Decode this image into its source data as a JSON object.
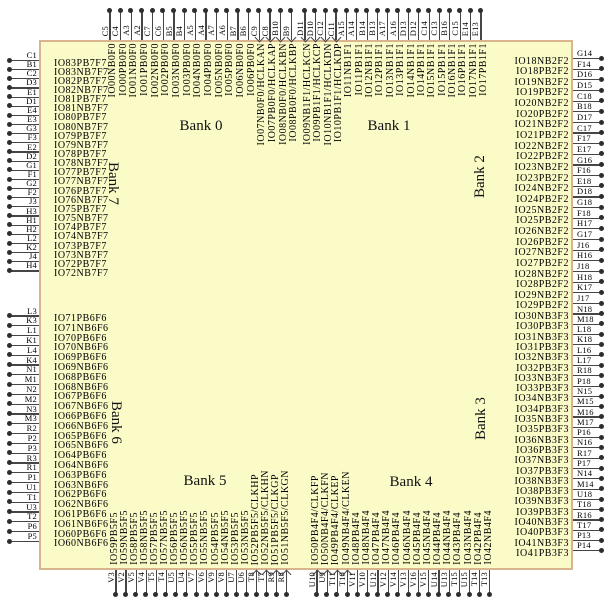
{
  "colors": {
    "chip_fill": "#FBFBC8",
    "chip_border": "#D9B48F",
    "wire": "#454545"
  },
  "banks": [
    {
      "label": "Bank 0"
    },
    {
      "label": "Bank 1"
    },
    {
      "label": "Bank 2"
    },
    {
      "label": "Bank 3"
    },
    {
      "label": "Bank 4"
    },
    {
      "label": "Bank 5"
    },
    {
      "label": "Bank 6"
    },
    {
      "label": "Bank 7"
    }
  ],
  "pins": {
    "top_bank0": [
      {
        "pin": "C5",
        "label": "IO00NB0F0"
      },
      {
        "pin": "C4",
        "label": "IO00PB0F0"
      },
      {
        "pin": "A3",
        "label": "IO01NB0F0"
      },
      {
        "pin": "A2",
        "label": "IO01PB0F0"
      },
      {
        "pin": "C7",
        "label": "IO02NB0F0"
      },
      {
        "pin": "C6",
        "label": "IO02PB0F0"
      },
      {
        "pin": "B5",
        "label": "IO03NB0F0"
      },
      {
        "pin": "B4",
        "label": "IO03PB0F0"
      },
      {
        "pin": "A5",
        "label": "IO04NB0F0"
      },
      {
        "pin": "A4",
        "label": "IO04PB0F0"
      },
      {
        "pin": "A7",
        "label": "IO05NB0F0"
      },
      {
        "pin": "A6",
        "label": "IO05PB0F0"
      },
      {
        "pin": "B7",
        "label": "IO06NB0F0"
      },
      {
        "pin": "B6",
        "label": "IO06PB0F0"
      },
      {
        "pin": "C9",
        "label": "IO07NB0F0/HCLKAN"
      },
      {
        "pin": "C8",
        "label": "IO07PB0F0/HCLKAP"
      },
      {
        "pin": "B10",
        "label": "IO08NB0F0/HCLKBN"
      },
      {
        "pin": "B9",
        "label": "IO08PB0F0/HCLKBP"
      }
    ],
    "top_bank1": [
      {
        "pin": "D11",
        "label": "IO09NB1F1/HCLKCN"
      },
      {
        "pin": "D10",
        "label": "IO09PB1F1/HCLKCP"
      },
      {
        "pin": "C12",
        "label": "IO10NB1F1/HCLKDN"
      },
      {
        "pin": "C11",
        "label": "IO10PB1F1/HCLKDP"
      },
      {
        "pin": "A15",
        "label": "IO11NB1F1"
      },
      {
        "pin": "A14",
        "label": "IO11PB1F1"
      },
      {
        "pin": "B14",
        "label": "IO12NB1F1"
      },
      {
        "pin": "B13",
        "label": "IO12PB1F1"
      },
      {
        "pin": "A17",
        "label": "IO13NB1F1"
      },
      {
        "pin": "A16",
        "label": "IO13PB1F1"
      },
      {
        "pin": "D13",
        "label": "IO14NB1F1"
      },
      {
        "pin": "D12",
        "label": "IO14PB1F1"
      },
      {
        "pin": "C14",
        "label": "IO15NB1F1"
      },
      {
        "pin": "C13",
        "label": "IO15PB1F1"
      },
      {
        "pin": "B16",
        "label": "IO16NB1F1"
      },
      {
        "pin": "C15",
        "label": "IO16PB1F1"
      },
      {
        "pin": "E14",
        "label": "IO17NB1F1"
      },
      {
        "pin": "E13",
        "label": "IO17PB1F1"
      }
    ],
    "right_bank2": [
      {
        "pin": "G14",
        "label": "IO18NB2F2"
      },
      {
        "pin": "F14",
        "label": "IO18PB2F2"
      },
      {
        "pin": "D16",
        "label": "IO19NB2F2"
      },
      {
        "pin": "D15",
        "label": "IO19PB2F2"
      },
      {
        "pin": "C18",
        "label": "IO20NB2F2"
      },
      {
        "pin": "B18",
        "label": "IO20PB2F2"
      },
      {
        "pin": "D17",
        "label": "IO21NB2F2"
      },
      {
        "pin": "C17",
        "label": "IO21PB2F2"
      },
      {
        "pin": "F17",
        "label": "IO22NB2F2"
      },
      {
        "pin": "E17",
        "label": "IO22PB2F2"
      },
      {
        "pin": "G16",
        "label": "IO23NB2F2"
      },
      {
        "pin": "F16",
        "label": "IO23PB2F2"
      },
      {
        "pin": "E18",
        "label": "IO24NB2F2"
      },
      {
        "pin": "D18",
        "label": "IO24PB2F2"
      },
      {
        "pin": "G18",
        "label": "IO25NB2F2"
      },
      {
        "pin": "F18",
        "label": "IO25PB2F2"
      },
      {
        "pin": "H17",
        "label": "IO26NB2F2"
      },
      {
        "pin": "G17",
        "label": "IO26PB2F2"
      },
      {
        "pin": "J16",
        "label": "IO27NB2F2"
      },
      {
        "pin": "H16",
        "label": "IO27PB2F2"
      },
      {
        "pin": "J18",
        "label": "IO28NB2F2"
      },
      {
        "pin": "H18",
        "label": "IO28PB2F2"
      },
      {
        "pin": "K17",
        "label": "IO29NB2F2"
      },
      {
        "pin": "J17",
        "label": "IO29PB2F2"
      }
    ],
    "right_bank3": [
      {
        "pin": "N18",
        "label": "IO30NB3F3"
      },
      {
        "pin": "M18",
        "label": "IO30PB3F3"
      },
      {
        "pin": "L18",
        "label": "IO31NB3F3"
      },
      {
        "pin": "K18",
        "label": "IO31PB3F3"
      },
      {
        "pin": "L16",
        "label": "IO32NB3F3"
      },
      {
        "pin": "L17",
        "label": "IO32PB3F3"
      },
      {
        "pin": "R18",
        "label": "IO33NB3F3"
      },
      {
        "pin": "P18",
        "label": "IO33PB3F3"
      },
      {
        "pin": "N15",
        "label": "IO34NB3F3"
      },
      {
        "pin": "M15",
        "label": "IO34PB3F3"
      },
      {
        "pin": "M16",
        "label": "IO35NB3F3"
      },
      {
        "pin": "M17",
        "label": "IO35PB3F3"
      },
      {
        "pin": "P16",
        "label": "IO36NB3F3"
      },
      {
        "pin": "N16",
        "label": "IO36PB3F3"
      },
      {
        "pin": "R17",
        "label": "IO37NB3F3"
      },
      {
        "pin": "P17",
        "label": "IO37PB3F3"
      },
      {
        "pin": "N14",
        "label": "IO38NB3F3"
      },
      {
        "pin": "M14",
        "label": "IO38PB3F3"
      },
      {
        "pin": "U18",
        "label": "IO39NB3F3"
      },
      {
        "pin": "T18",
        "label": "IO39PB3F3"
      },
      {
        "pin": "R16",
        "label": "IO40NB3F3"
      },
      {
        "pin": "T17",
        "label": "IO40PB3F3"
      },
      {
        "pin": "P13",
        "label": "IO41NB3F3"
      },
      {
        "pin": "P14",
        "label": "IO41PB3F3"
      }
    ],
    "left_bank7": [
      {
        "pin": "C1",
        "label": "IO83PB7F7"
      },
      {
        "pin": "B1",
        "label": "IO83NB7F7"
      },
      {
        "pin": "C2",
        "label": "IO82PB7F7"
      },
      {
        "pin": "D3",
        "label": "IO82NB7F7"
      },
      {
        "pin": "E1",
        "label": "IO81PB7F7"
      },
      {
        "pin": "D1",
        "label": "IO81NB7F7"
      },
      {
        "pin": "E4",
        "label": "IO80PB7F7"
      },
      {
        "pin": "E3",
        "label": "IO80NB7F7"
      },
      {
        "pin": "G3",
        "label": "IO79PB7F7"
      },
      {
        "pin": "F3",
        "label": "IO79NB7F7"
      },
      {
        "pin": "E2",
        "label": "IO78PB7F7"
      },
      {
        "pin": "D2",
        "label": "IO78NB7F7"
      },
      {
        "pin": "G1",
        "label": "IO77PB7F7"
      },
      {
        "pin": "F1",
        "label": "IO77NB7F7"
      },
      {
        "pin": "G2",
        "label": "IO76PB7F7"
      },
      {
        "pin": "F2",
        "label": "IO76NB7F7"
      },
      {
        "pin": "J3",
        "label": "IO75PB7F7"
      },
      {
        "pin": "H3",
        "label": "IO75NB7F7"
      },
      {
        "pin": "H1",
        "label": "IO74PB7F7"
      },
      {
        "pin": "H2",
        "label": "IO74NB7F7"
      },
      {
        "pin": "L2",
        "label": "IO73PB7F7"
      },
      {
        "pin": "K2",
        "label": "IO73NB7F7"
      },
      {
        "pin": "J4",
        "label": "IO72PB7F7"
      },
      {
        "pin": "H4",
        "label": "IO72NB7F7"
      }
    ],
    "left_bank6": [
      {
        "pin": "L3",
        "label": "IO71PB6F6"
      },
      {
        "pin": "K3",
        "label": "IO71NB6F6"
      },
      {
        "pin": "L1",
        "label": "IO70PB6F6"
      },
      {
        "pin": "K1",
        "label": "IO70NB6F6"
      },
      {
        "pin": "L4",
        "label": "IO69PB6F6"
      },
      {
        "pin": "K4",
        "label": "IO69NB6F6"
      },
      {
        "pin": "N1",
        "label": "IO68PB6F6"
      },
      {
        "pin": "M1",
        "label": "IO68NB6F6"
      },
      {
        "pin": "N2",
        "label": "IO67PB6F6"
      },
      {
        "pin": "M2",
        "label": "IO67NB6F6"
      },
      {
        "pin": "N3",
        "label": "IO66PB6F6"
      },
      {
        "pin": "M3",
        "label": "IO66NB6F6"
      },
      {
        "pin": "R2",
        "label": "IO65PB6F6"
      },
      {
        "pin": "P2",
        "label": "IO65NB6F6"
      },
      {
        "pin": "P3",
        "label": "IO64PB6F6"
      },
      {
        "pin": "R3",
        "label": "IO64NB6F6"
      },
      {
        "pin": "R1",
        "label": "IO63PB6F6"
      },
      {
        "pin": "P1",
        "label": "IO63NB6F6"
      },
      {
        "pin": "U1",
        "label": "IO62PB6F6"
      },
      {
        "pin": "T1",
        "label": "IO62NB6F6"
      },
      {
        "pin": "U3",
        "label": "IO61PB6F6"
      },
      {
        "pin": "T2",
        "label": "IO61NB6F6"
      },
      {
        "pin": "P6",
        "label": "IO60PB6F6"
      },
      {
        "pin": "P5",
        "label": "IO60NB6F6"
      }
    ],
    "bottom_bank5": [
      {
        "pin": "V3",
        "label": "IO59PB5F5"
      },
      {
        "pin": "V2",
        "label": "IO59NB5F5"
      },
      {
        "pin": "V5",
        "label": "IO58PB5F5"
      },
      {
        "pin": "V4",
        "label": "IO58NB5F5"
      },
      {
        "pin": "T5",
        "label": "IO57PB5F5"
      },
      {
        "pin": "T4",
        "label": "IO57NB5F5"
      },
      {
        "pin": "U5",
        "label": "IO56PB5F5"
      },
      {
        "pin": "U4",
        "label": "IO56NB5F5"
      },
      {
        "pin": "V7",
        "label": "IO55PB5F5"
      },
      {
        "pin": "V6",
        "label": "IO55NB5F5"
      },
      {
        "pin": "V9",
        "label": "IO54PB5F5"
      },
      {
        "pin": "V8",
        "label": "IO54NB5F5"
      },
      {
        "pin": "U7",
        "label": "IO53PB5F5"
      },
      {
        "pin": "U6",
        "label": "IO53NB5F5"
      },
      {
        "pin": "T8",
        "label": "IO52PB5F5/CLKHP"
      },
      {
        "pin": "T7",
        "label": "IO52NB5F5/CLKHN"
      },
      {
        "pin": "R9",
        "label": "IO51PB5F5/CLKGP"
      },
      {
        "pin": "R8",
        "label": "IO51NB5F5/CLKGN"
      }
    ],
    "bottom_bank4": [
      {
        "pin": "U10",
        "label": "IO50PB4F4/CLKFP"
      },
      {
        "pin": "U9",
        "label": "IO50NB4F4/CLKFN"
      },
      {
        "pin": "T11",
        "label": "IO49PB4F4/CLKEP"
      },
      {
        "pin": "T10",
        "label": "IO49NB4F4/CLKEN"
      },
      {
        "pin": "V11",
        "label": "IO48PB4F4"
      },
      {
        "pin": "V10",
        "label": "IO48NB4F4"
      },
      {
        "pin": "U12",
        "label": "IO47PB4F4"
      },
      {
        "pin": "V12",
        "label": "IO47NB4F4"
      },
      {
        "pin": "V14",
        "label": "IO46PB4F4"
      },
      {
        "pin": "V13",
        "label": "IO46NB4F4"
      },
      {
        "pin": "V16",
        "label": "IO45PB4F4"
      },
      {
        "pin": "V15",
        "label": "IO45NB4F4"
      },
      {
        "pin": "U14",
        "label": "IO44PB4F4"
      },
      {
        "pin": "U13",
        "label": "IO44NB4F4"
      },
      {
        "pin": "T15",
        "label": "IO43PB4F4"
      },
      {
        "pin": "U15",
        "label": "IO43NB4F4"
      },
      {
        "pin": "T14",
        "label": "IO42PB4F4"
      },
      {
        "pin": "T13",
        "label": "IO42NB4F4"
      }
    ]
  }
}
